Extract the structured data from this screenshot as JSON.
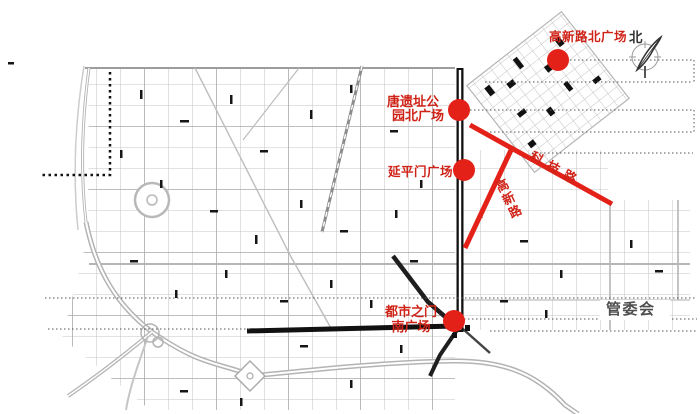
{
  "figure": {
    "kind": "urban-planning-map"
  },
  "markers": [
    {
      "name": "gaoxin-road-north-plaza",
      "label": "高新路北广场"
    },
    {
      "name": "tang-relic-park-north-plaza",
      "line1": "唐遗址公",
      "line2": "园北广场"
    },
    {
      "name": "yanpingmen-plaza",
      "label": "延平门广场"
    },
    {
      "name": "city-gate-south-plaza",
      "line1": "都市之门",
      "line2": "南广场"
    }
  ],
  "roads": {
    "keji": "科技路",
    "gaoxin": "高新路"
  },
  "annotations": {
    "north": "北",
    "management_committee": "管委会"
  },
  "colors": {
    "marker_red": "#e32119",
    "label_red": "#d02318",
    "road_dark": "#161616",
    "street_gray": "#c6c6c6",
    "text_gray": "#4f4f4f"
  }
}
